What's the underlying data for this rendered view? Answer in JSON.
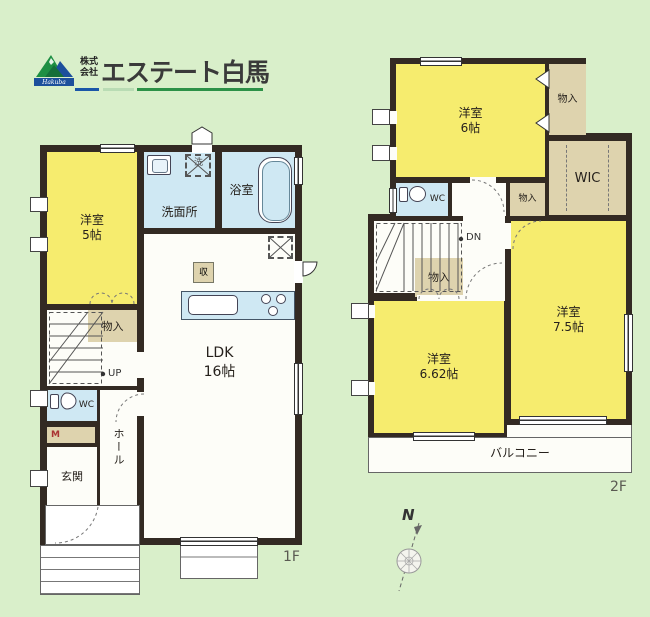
{
  "colors": {
    "room_yellow": "#f6ec6e",
    "water_blue": "#cfe8f3",
    "storage_beige": "#ded3ae",
    "wall": "#332a23",
    "background": "#d9efca",
    "accent_green": "#2c9147",
    "accent_blue": "#1a56a8"
  },
  "logo": {
    "company_prefix_line1": "株式",
    "company_prefix_line2": "会社",
    "company_name": "エステート白馬",
    "emblem_script": "Hakuba"
  },
  "floor1": {
    "floor_label": "1F",
    "western_room": "洋室\n5帖",
    "washroom": "洗面所",
    "bathroom": "浴室",
    "ldk": "LDK\n16帖",
    "storage": "物入",
    "closet_mark": "収",
    "laundry_mark": "洗",
    "stairs_up": "UP",
    "toilet": "WC",
    "meter_box": "M",
    "entrance": "玄関",
    "hall": "ホール"
  },
  "floor2": {
    "floor_label": "2F",
    "western_room_6": "洋室\n6帖",
    "storage_top": "物入",
    "wic": "WIC",
    "toilet": "WC",
    "storage_hall": "物入",
    "stairs_down": "DN",
    "storage_mid": "物入",
    "western_room_662": "洋室\n6.62帖",
    "western_room_75": "洋室\n7.5帖",
    "balcony": "バルコニー"
  },
  "compass": {
    "north_label": "N"
  }
}
